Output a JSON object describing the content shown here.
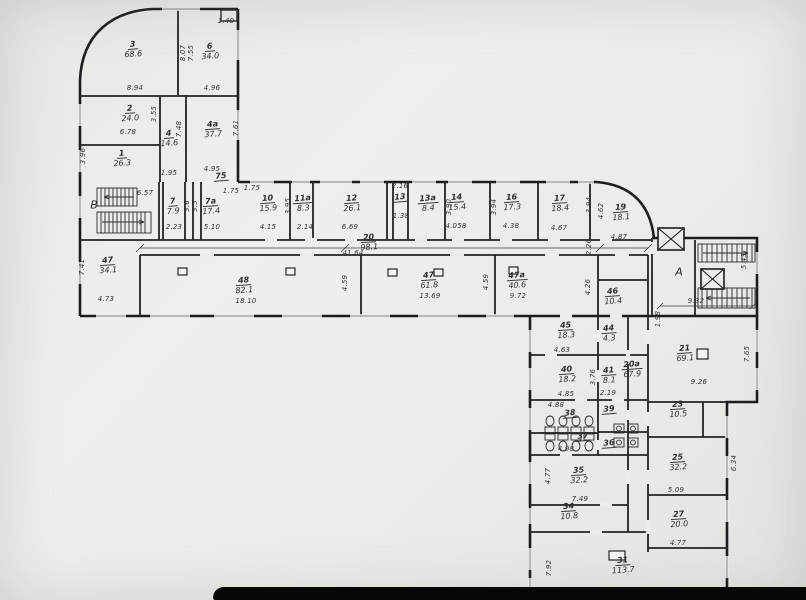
{
  "document": {
    "kind": "architectural floor plan",
    "units": "meters / square meters"
  },
  "colors": {
    "paper": "#ececea",
    "wall": "#1d1d1d",
    "ink": "#333333",
    "photo_edge": "#070707"
  },
  "zones": [
    {
      "t": "В",
      "x": 94,
      "y": 205
    },
    {
      "t": "А",
      "x": 679,
      "y": 272
    }
  ],
  "rooms": [
    {
      "n": "3",
      "a": "68.6",
      "x": 133,
      "y": 50
    },
    {
      "n": "6",
      "a": "34.0",
      "x": 210,
      "y": 52
    },
    {
      "n": "2",
      "a": "24.0",
      "x": 130,
      "y": 114
    },
    {
      "n": "4",
      "a": "14.6",
      "x": 169,
      "y": 139
    },
    {
      "n": "4а",
      "a": "37.7",
      "x": 213,
      "y": 130
    },
    {
      "n": "1",
      "a": "26.3",
      "x": 122,
      "y": 159
    },
    {
      "n": "75",
      "a": "",
      "x": 221,
      "y": 177
    },
    {
      "n": "7",
      "a": "7.9",
      "x": 173,
      "y": 207
    },
    {
      "n": "7а",
      "a": "17.4",
      "x": 211,
      "y": 207
    },
    {
      "n": "10",
      "a": "15.9",
      "x": 268,
      "y": 204
    },
    {
      "n": "11а",
      "a": "8.3",
      "x": 303,
      "y": 204
    },
    {
      "n": "12",
      "a": "26.1",
      "x": 352,
      "y": 204
    },
    {
      "n": "13",
      "a": "",
      "x": 400,
      "y": 198
    },
    {
      "n": "13а",
      "a": "8.4",
      "x": 428,
      "y": 204
    },
    {
      "n": "14",
      "a": "15.4",
      "x": 457,
      "y": 203
    },
    {
      "n": "16",
      "a": "17.3",
      "x": 512,
      "y": 203
    },
    {
      "n": "17",
      "a": "18.4",
      "x": 560,
      "y": 204
    },
    {
      "n": "19",
      "a": "18.1",
      "x": 621,
      "y": 213
    },
    {
      "n": "20",
      "a": "98.1",
      "x": 369,
      "y": 243
    },
    {
      "n": "47",
      "a": "34.1",
      "x": 108,
      "y": 266
    },
    {
      "n": "48",
      "a": "82.1",
      "x": 244,
      "y": 286
    },
    {
      "n": "47",
      "a": "61.8",
      "x": 429,
      "y": 281
    },
    {
      "n": "47а",
      "a": "40.6",
      "x": 517,
      "y": 281
    },
    {
      "n": "46",
      "a": "10.4",
      "x": 613,
      "y": 297
    },
    {
      "n": "45",
      "a": "18.3",
      "x": 566,
      "y": 331
    },
    {
      "n": "44",
      "a": "4.3",
      "x": 609,
      "y": 334
    },
    {
      "n": "40",
      "a": "18.2",
      "x": 567,
      "y": 375
    },
    {
      "n": "41",
      "a": "8.1",
      "x": 609,
      "y": 376
    },
    {
      "n": "20а",
      "a": "67.9",
      "x": 632,
      "y": 370
    },
    {
      "n": "38",
      "a": "",
      "x": 570,
      "y": 414
    },
    {
      "n": "39",
      "a": "",
      "x": 609,
      "y": 410
    },
    {
      "n": "37",
      "a": "",
      "x": 583,
      "y": 437
    },
    {
      "n": "36",
      "a": "",
      "x": 609,
      "y": 444
    },
    {
      "n": "35",
      "a": "32.2",
      "x": 579,
      "y": 476
    },
    {
      "n": "34",
      "a": "10.8",
      "x": 569,
      "y": 512
    },
    {
      "n": "31",
      "a": "113.7",
      "x": 623,
      "y": 566
    },
    {
      "n": "21",
      "a": "69.1",
      "x": 685,
      "y": 354
    },
    {
      "n": "23",
      "a": "10.5",
      "x": 678,
      "y": 410
    },
    {
      "n": "25",
      "a": "32.2",
      "x": 678,
      "y": 463
    },
    {
      "n": "27",
      "a": "20.0",
      "x": 679,
      "y": 520
    }
  ],
  "dims": [
    {
      "t": "1.40",
      "x": 226,
      "y": 21
    },
    {
      "t": "8.94",
      "x": 135,
      "y": 88
    },
    {
      "t": "4.96",
      "x": 212,
      "y": 88
    },
    {
      "t": "8.07",
      "x": 183,
      "y": 53,
      "r": true
    },
    {
      "t": "7.55",
      "x": 191,
      "y": 53,
      "r": true
    },
    {
      "t": "3.55",
      "x": 154,
      "y": 114,
      "r": true
    },
    {
      "t": "6.78",
      "x": 128,
      "y": 132
    },
    {
      "t": "7.48",
      "x": 179,
      "y": 129,
      "r": true
    },
    {
      "t": "7.61",
      "x": 236,
      "y": 128,
      "r": true
    },
    {
      "t": "3.96",
      "x": 83,
      "y": 156,
      "r": true
    },
    {
      "t": "4.95",
      "x": 212,
      "y": 169
    },
    {
      "t": "1.95",
      "x": 169,
      "y": 173
    },
    {
      "t": "6.57",
      "x": 145,
      "y": 193
    },
    {
      "t": "1.75",
      "x": 231,
      "y": 191
    },
    {
      "t": "1.75",
      "x": 252,
      "y": 188
    },
    {
      "t": "2.23",
      "x": 174,
      "y": 227
    },
    {
      "t": "5.10",
      "x": 212,
      "y": 227
    },
    {
      "t": "3.6",
      "x": 187,
      "y": 206,
      "r": true
    },
    {
      "t": "3.5",
      "x": 195,
      "y": 206,
      "r": true
    },
    {
      "t": "4.15",
      "x": 268,
      "y": 227
    },
    {
      "t": "3.95",
      "x": 288,
      "y": 206,
      "r": true
    },
    {
      "t": "2.14",
      "x": 305,
      "y": 227
    },
    {
      "t": "6.69",
      "x": 350,
      "y": 227
    },
    {
      "t": "2.16",
      "x": 400,
      "y": 186
    },
    {
      "t": "1.38",
      "x": 401,
      "y": 216
    },
    {
      "t": "3.90",
      "x": 449,
      "y": 207,
      "r": true
    },
    {
      "t": "4.058",
      "x": 456,
      "y": 226
    },
    {
      "t": "3.94",
      "x": 494,
      "y": 207,
      "r": true
    },
    {
      "t": "4.38",
      "x": 511,
      "y": 226
    },
    {
      "t": "4.67",
      "x": 559,
      "y": 228
    },
    {
      "t": "3.94",
      "x": 589,
      "y": 205,
      "r": true
    },
    {
      "t": "4.62",
      "x": 601,
      "y": 211,
      "r": true
    },
    {
      "t": "4.87",
      "x": 619,
      "y": 237
    },
    {
      "t": "41.64",
      "x": 353,
      "y": 253
    },
    {
      "t": "7.41",
      "x": 82,
      "y": 267,
      "r": true
    },
    {
      "t": "4.73",
      "x": 106,
      "y": 299
    },
    {
      "t": "18.10",
      "x": 246,
      "y": 301
    },
    {
      "t": "4.59",
      "x": 345,
      "y": 283,
      "r": true
    },
    {
      "t": "13.69",
      "x": 430,
      "y": 296
    },
    {
      "t": "4.59",
      "x": 486,
      "y": 282,
      "r": true
    },
    {
      "t": "9.72",
      "x": 518,
      "y": 296
    },
    {
      "t": "4.26",
      "x": 588,
      "y": 287,
      "r": true
    },
    {
      "t": "2.26",
      "x": 589,
      "y": 247,
      "r": true
    },
    {
      "t": "1.98",
      "x": 658,
      "y": 319,
      "r": true
    },
    {
      "t": "9.32",
      "x": 696,
      "y": 301
    },
    {
      "t": "5.43",
      "x": 744,
      "y": 261,
      "r": true
    },
    {
      "t": "4.63",
      "x": 562,
      "y": 350
    },
    {
      "t": "4.85",
      "x": 566,
      "y": 394
    },
    {
      "t": "2.19",
      "x": 608,
      "y": 393
    },
    {
      "t": "3.76",
      "x": 593,
      "y": 377,
      "r": true
    },
    {
      "t": "4.88",
      "x": 556,
      "y": 405
    },
    {
      "t": "4.98",
      "x": 566,
      "y": 449
    },
    {
      "t": "7.49",
      "x": 580,
      "y": 499
    },
    {
      "t": "4.77",
      "x": 548,
      "y": 476,
      "r": true
    },
    {
      "t": "7.92",
      "x": 549,
      "y": 568,
      "r": true
    },
    {
      "t": "9.26",
      "x": 699,
      "y": 382
    },
    {
      "t": "7.65",
      "x": 747,
      "y": 354,
      "r": true
    },
    {
      "t": "5.09",
      "x": 676,
      "y": 490
    },
    {
      "t": "6.34",
      "x": 734,
      "y": 463,
      "r": true
    },
    {
      "t": "4.77",
      "x": 678,
      "y": 543
    }
  ]
}
